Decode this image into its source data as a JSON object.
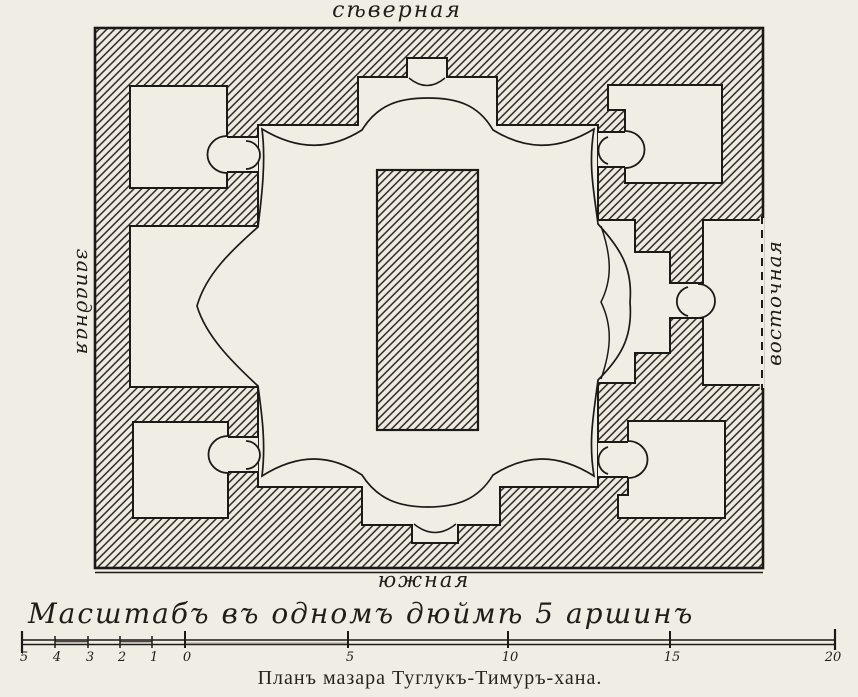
{
  "page": {
    "paper_color": "#f0ede5",
    "ink_color": "#1c1a17"
  },
  "plan": {
    "orientation_labels": {
      "north": "сѣверная",
      "south": "южная",
      "west": "западная",
      "east": "восточная"
    }
  },
  "scale_bar": {
    "caption": "Масштабъ въ одномъ дюймѣ 5 аршинъ",
    "ticks": [
      {
        "label": "5"
      },
      {
        "label": "4"
      },
      {
        "label": "3"
      },
      {
        "label": "2"
      },
      {
        "label": "1"
      },
      {
        "label": "0"
      },
      {
        "label": "5"
      },
      {
        "label": "10"
      },
      {
        "label": "15"
      },
      {
        "label": "20"
      }
    ]
  },
  "caption": "Планъ мазара Туглукъ-Тимуръ-хана."
}
